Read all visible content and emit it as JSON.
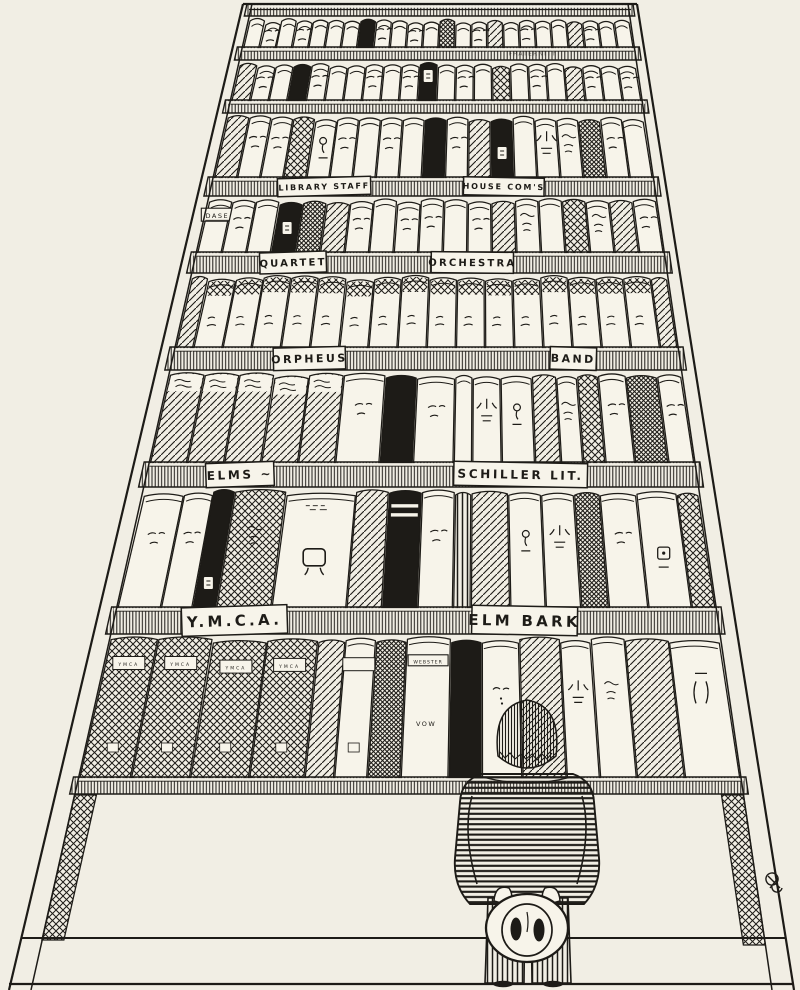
{
  "scene": {
    "description": "Hand-drawn ink cartoon: a man seen from behind, holding his hat behind his back, stands before an impossibly tall bookcase whose shelves carry labeled plates",
    "colors": {
      "paper": "#f1eee4",
      "ink": "#1d1b17",
      "book_white": "#f7f4ea"
    },
    "boards": [
      {
        "y": 4,
        "h": 12,
        "labels": []
      },
      {
        "y": 47,
        "h": 13,
        "labels": [
          {
            "text": "FRATERNITY",
            "pos": 0.74,
            "fs": 6,
            "faint": true
          }
        ]
      },
      {
        "y": 100,
        "h": 13,
        "labels": []
      },
      {
        "y": 177,
        "h": 19,
        "labels": [
          {
            "text": "LIBRARY STAFF",
            "pos": 0.255,
            "fs": 8
          },
          {
            "text": "HOUSE COM'S",
            "pos": 0.66,
            "fs": 8
          }
        ]
      },
      {
        "y": 252,
        "h": 21,
        "labels": [
          {
            "text": "QUARTET",
            "pos": 0.21,
            "fs": 10
          },
          {
            "text": "ORCHESTRA",
            "pos": 0.59,
            "fs": 10
          }
        ]
      },
      {
        "y": 347,
        "h": 23,
        "labels": [
          {
            "text": "ORPHEUS",
            "pos": 0.27,
            "fs": 11
          },
          {
            "text": "BAND",
            "pos": 0.79,
            "fs": 11
          }
        ]
      },
      {
        "y": 462,
        "h": 25,
        "labels": [
          {
            "text": "ELMS ~",
            "pos": 0.17,
            "fs": 12
          },
          {
            "text": "SCHILLER LIT.",
            "pos": 0.68,
            "fs": 12
          }
        ]
      },
      {
        "y": 607,
        "h": 27,
        "labels": [
          {
            "text": "Y.M.C.A.",
            "pos": 0.2,
            "fs": 15
          },
          {
            "text": "ELM BARK",
            "pos": 0.68,
            "fs": 15
          }
        ]
      },
      {
        "y": 777,
        "h": 17,
        "labels": []
      }
    ],
    "rows": [
      {
        "name": "a",
        "y0": 16,
        "y1": 47,
        "books": [
          {
            "s": "w"
          },
          {
            "s": "w",
            "m": "dash"
          },
          {
            "s": "w"
          },
          {
            "s": "w",
            "m": "dash"
          },
          {
            "s": "w"
          },
          {
            "s": "w"
          },
          {
            "s": "w"
          },
          {
            "s": "b"
          },
          {
            "s": "w",
            "m": "dash"
          },
          {
            "s": "w"
          },
          {
            "s": "w",
            "m": "dash"
          },
          {
            "s": "w"
          },
          {
            "s": "d"
          },
          {
            "s": "w"
          },
          {
            "s": "w",
            "m": "dash"
          },
          {
            "s": "h"
          },
          {
            "s": "w"
          },
          {
            "s": "w",
            "m": "dash"
          },
          {
            "s": "w"
          },
          {
            "s": "w"
          },
          {
            "s": "h"
          },
          {
            "s": "w",
            "m": "dash"
          },
          {
            "s": "w"
          },
          {
            "s": "w"
          }
        ]
      },
      {
        "name": "b",
        "y0": 60,
        "y1": 100,
        "books": [
          {
            "s": "h"
          },
          {
            "s": "w",
            "m": "dash"
          },
          {
            "s": "w"
          },
          {
            "s": "b"
          },
          {
            "s": "w",
            "m": "dash"
          },
          {
            "s": "w"
          },
          {
            "s": "w"
          },
          {
            "s": "w",
            "m": "dash"
          },
          {
            "s": "w"
          },
          {
            "s": "w",
            "m": "dash"
          },
          {
            "s": "b",
            "m": "seal"
          },
          {
            "s": "w"
          },
          {
            "s": "w",
            "m": "dash"
          },
          {
            "s": "w"
          },
          {
            "s": "x"
          },
          {
            "s": "w"
          },
          {
            "s": "w",
            "m": "dash"
          },
          {
            "s": "w"
          },
          {
            "s": "h"
          },
          {
            "s": "w",
            "m": "dash"
          },
          {
            "s": "w"
          },
          {
            "s": "w",
            "m": "dash"
          }
        ]
      },
      {
        "name": "c",
        "y0": 113,
        "y1": 177,
        "books": [
          {
            "s": "h"
          },
          {
            "s": "w",
            "m": "dash"
          },
          {
            "s": "w",
            "m": "dash"
          },
          {
            "s": "x"
          },
          {
            "s": "w",
            "m": "glyph"
          },
          {
            "s": "w",
            "m": "dash"
          },
          {
            "s": "w"
          },
          {
            "s": "w",
            "m": "dash"
          },
          {
            "s": "w"
          },
          {
            "s": "b"
          },
          {
            "s": "w",
            "m": "dash"
          },
          {
            "s": "h"
          },
          {
            "s": "b",
            "m": "seal"
          },
          {
            "s": "w"
          },
          {
            "s": "w",
            "m": "glyph2"
          },
          {
            "s": "w",
            "m": "scr"
          },
          {
            "s": "d"
          },
          {
            "s": "w",
            "m": "dash"
          },
          {
            "s": "w"
          }
        ]
      },
      {
        "name": "d",
        "y0": 196,
        "y1": 252,
        "books": [
          {
            "s": "w",
            "m": "platelabel",
            "text": "DASE"
          },
          {
            "s": "w",
            "m": "dash"
          },
          {
            "s": "w"
          },
          {
            "s": "b",
            "m": "seal"
          },
          {
            "s": "d"
          },
          {
            "s": "h"
          },
          {
            "s": "w",
            "m": "dash"
          },
          {
            "s": "w"
          },
          {
            "s": "w",
            "m": "dash"
          },
          {
            "s": "w",
            "m": "dash"
          },
          {
            "s": "w"
          },
          {
            "s": "w",
            "m": "dash"
          },
          {
            "s": "h"
          },
          {
            "s": "w",
            "m": "scr"
          },
          {
            "s": "w"
          },
          {
            "s": "x"
          },
          {
            "s": "w",
            "m": "scr"
          },
          {
            "s": "h"
          },
          {
            "s": "w",
            "m": "dash"
          }
        ]
      },
      {
        "name": "e",
        "y0": 273,
        "y1": 347,
        "books": [
          {
            "s": "h",
            "w": 0.6
          },
          {
            "s": "v"
          },
          {
            "s": "v"
          },
          {
            "s": "v"
          },
          {
            "s": "v"
          },
          {
            "s": "v"
          },
          {
            "s": "v"
          },
          {
            "s": "v"
          },
          {
            "s": "v"
          },
          {
            "s": "v"
          },
          {
            "s": "v"
          },
          {
            "s": "v"
          },
          {
            "s": "v"
          },
          {
            "s": "v"
          },
          {
            "s": "v"
          },
          {
            "s": "v"
          },
          {
            "s": "v"
          },
          {
            "s": "h",
            "w": 0.6
          }
        ]
      },
      {
        "name": "f",
        "y0": 370,
        "y1": 462,
        "books": [
          {
            "s": "h",
            "m": "wavy"
          },
          {
            "s": "h",
            "m": "wavy"
          },
          {
            "s": "h",
            "m": "wavy"
          },
          {
            "s": "h",
            "m": "wavy"
          },
          {
            "s": "h",
            "m": "wavy"
          },
          {
            "s": "w",
            "m": "dash",
            "w": 1.2
          },
          {
            "s": "b",
            "w": 0.9
          },
          {
            "s": "w",
            "m": "dash",
            "w": 1.1
          },
          {
            "s": "w",
            "w": 0.5
          },
          {
            "s": "w",
            "m": "glyph2",
            "w": 0.8
          },
          {
            "s": "w",
            "m": "glyph",
            "w": 0.9
          },
          {
            "s": "h",
            "w": 0.7
          },
          {
            "s": "w",
            "m": "scr",
            "w": 0.6
          },
          {
            "s": "x",
            "w": 0.6
          },
          {
            "s": "w",
            "m": "dash",
            "w": 0.8
          },
          {
            "s": "d",
            "w": 0.9
          },
          {
            "s": "w",
            "m": "dash",
            "w": 0.7
          }
        ]
      },
      {
        "name": "g",
        "y0": 487,
        "y1": 607,
        "books": [
          {
            "s": "w",
            "m": "dash",
            "w": 1.1
          },
          {
            "s": "w",
            "m": "dash",
            "w": 0.8
          },
          {
            "s": "b",
            "m": "seal",
            "w": 0.6
          },
          {
            "s": "x",
            "m": "scr",
            "w": 1.4
          },
          {
            "s": "w",
            "m": "sym",
            "w": 1.9
          },
          {
            "s": "h",
            "w": 0.9
          },
          {
            "s": "b",
            "m": "bands",
            "w": 0.9
          },
          {
            "s": "w",
            "m": "dash",
            "w": 0.9
          },
          {
            "s": "s",
            "w": 0.45
          },
          {
            "s": "h",
            "w": 1.0
          },
          {
            "s": "w",
            "m": "glyph",
            "w": 0.9
          },
          {
            "s": "w",
            "m": "glyph2",
            "w": 0.9
          },
          {
            "s": "d",
            "w": 0.7
          },
          {
            "s": "w",
            "m": "dash",
            "w": 1.0
          },
          {
            "s": "w",
            "m": "sq",
            "w": 1.1
          },
          {
            "s": "x",
            "w": 0.6
          }
        ]
      },
      {
        "name": "h",
        "y0": 634,
        "y1": 777,
        "books": [
          {
            "s": "x",
            "m": "tlabel",
            "text": "YMCA",
            "w": 1.4
          },
          {
            "s": "x",
            "m": "tlabel",
            "text": "YMCA",
            "w": 1.6
          },
          {
            "s": "x",
            "m": "tlabel",
            "text": "YMCA",
            "w": 1.6
          },
          {
            "s": "x",
            "m": "tlabel",
            "text": "YMCA",
            "w": 1.5
          },
          {
            "s": "h",
            "w": 0.8
          },
          {
            "s": "w",
            "m": "tlabel",
            "text": "",
            "w": 0.9
          },
          {
            "s": "d",
            "w": 0.9
          },
          {
            "s": "w",
            "m": "webster",
            "text": "WEBSTER",
            "text2": "VOW",
            "w": 1.3
          },
          {
            "s": "b",
            "w": 0.9
          },
          {
            "s": "w",
            "m": "face",
            "w": 1.1
          },
          {
            "s": "h",
            "w": 1.2
          },
          {
            "s": "w",
            "m": "glyph2",
            "w": 0.9
          },
          {
            "s": "w",
            "m": "scr",
            "w": 1.0
          },
          {
            "s": "h",
            "w": 1.3
          },
          {
            "s": "w",
            "m": "marks",
            "w": 1.5
          }
        ]
      }
    ],
    "figure": {
      "pose": "standing, hands behind back, holding straw hat"
    }
  }
}
